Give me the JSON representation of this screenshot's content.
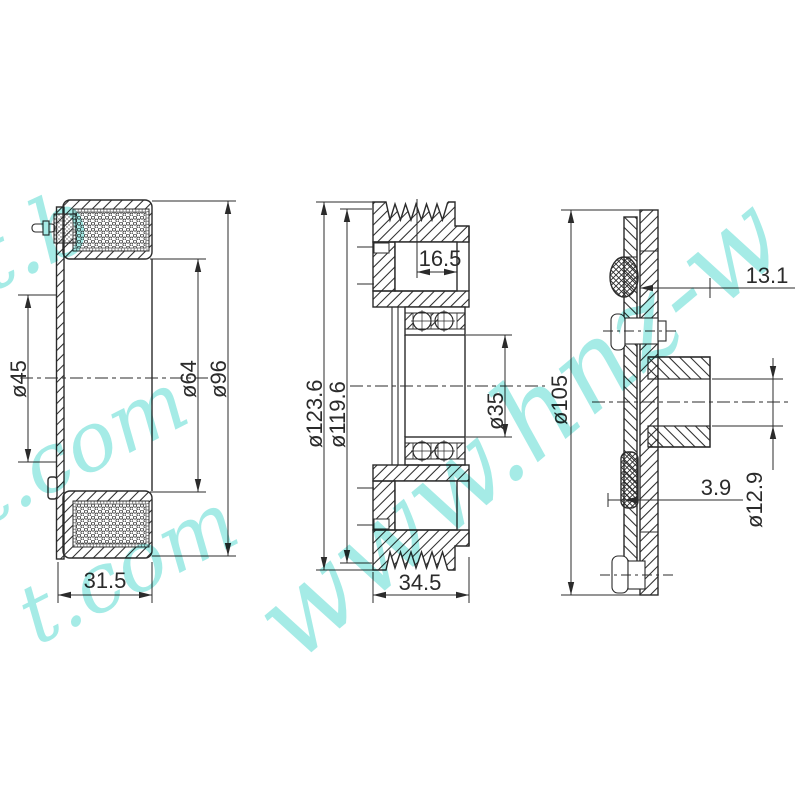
{
  "drawing": {
    "line_color": "#2b2b2b",
    "background": "#ffffff"
  },
  "watermark": {
    "color": "#8ee6e0",
    "fragments": [
      {
        "text": "t.b"
      },
      {
        "text": "t.com"
      },
      {
        "text": "t.com"
      },
      {
        "text": "www.hnz-w"
      }
    ]
  },
  "views": {
    "coil": {
      "dims": {
        "d45": "ø45",
        "d64": "ø64",
        "d96": "ø96",
        "width": "31.5"
      }
    },
    "pulley": {
      "dims": {
        "d1236": "ø123.6",
        "d1196": "ø119.6",
        "d35": "ø35",
        "recess": "16.5",
        "width": "34.5"
      }
    },
    "hub": {
      "dims": {
        "d105": "ø105",
        "offset": "13.1",
        "thickness": "3.9",
        "bore": "ø12.9"
      }
    }
  }
}
